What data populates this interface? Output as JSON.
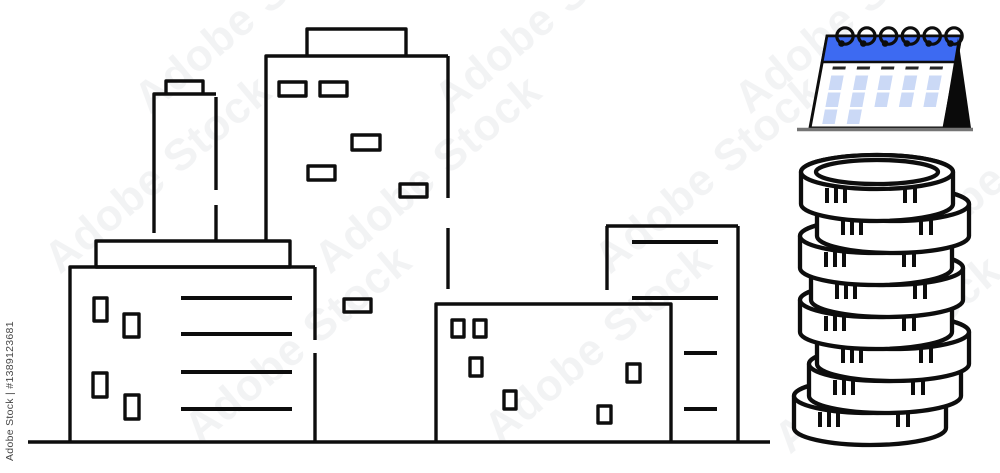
{
  "meta": {
    "description": "Black outline line-art of four city buildings beside a blue desk flip calendar and a stack of eight coins"
  },
  "watermark": {
    "tile_text": "Adobe Stock",
    "credit_text": "Adobe Stock | #1389123681"
  },
  "colors": {
    "background": "#ffffff",
    "line_black": "#0d0d0d",
    "calendar_header_blue": "#3d6af2",
    "calendar_cell_blue": "#cbd9f6",
    "calendar_dash_dark": "#262626",
    "calendar_side_black": "#0a0a0a",
    "baseline_gray": "#757575",
    "watermark_gray": "#959ba6"
  },
  "illustration": {
    "buildings": [
      {
        "name": "left-factory-building",
        "windows": 4,
        "floor_lines": 4,
        "rooftop_tower": true
      },
      {
        "name": "tall-tower-building",
        "windows": 6,
        "roof_step": true
      },
      {
        "name": "low-wide-building",
        "windows": 6
      },
      {
        "name": "right-building",
        "floor_lines": 4
      }
    ],
    "calendar": {
      "rings": 6,
      "dashes": 5,
      "cell_rows": [
        5,
        5,
        2
      ]
    },
    "coins": {
      "count": 8,
      "ticks_left_group": 3,
      "ticks_right_group": 2
    }
  }
}
